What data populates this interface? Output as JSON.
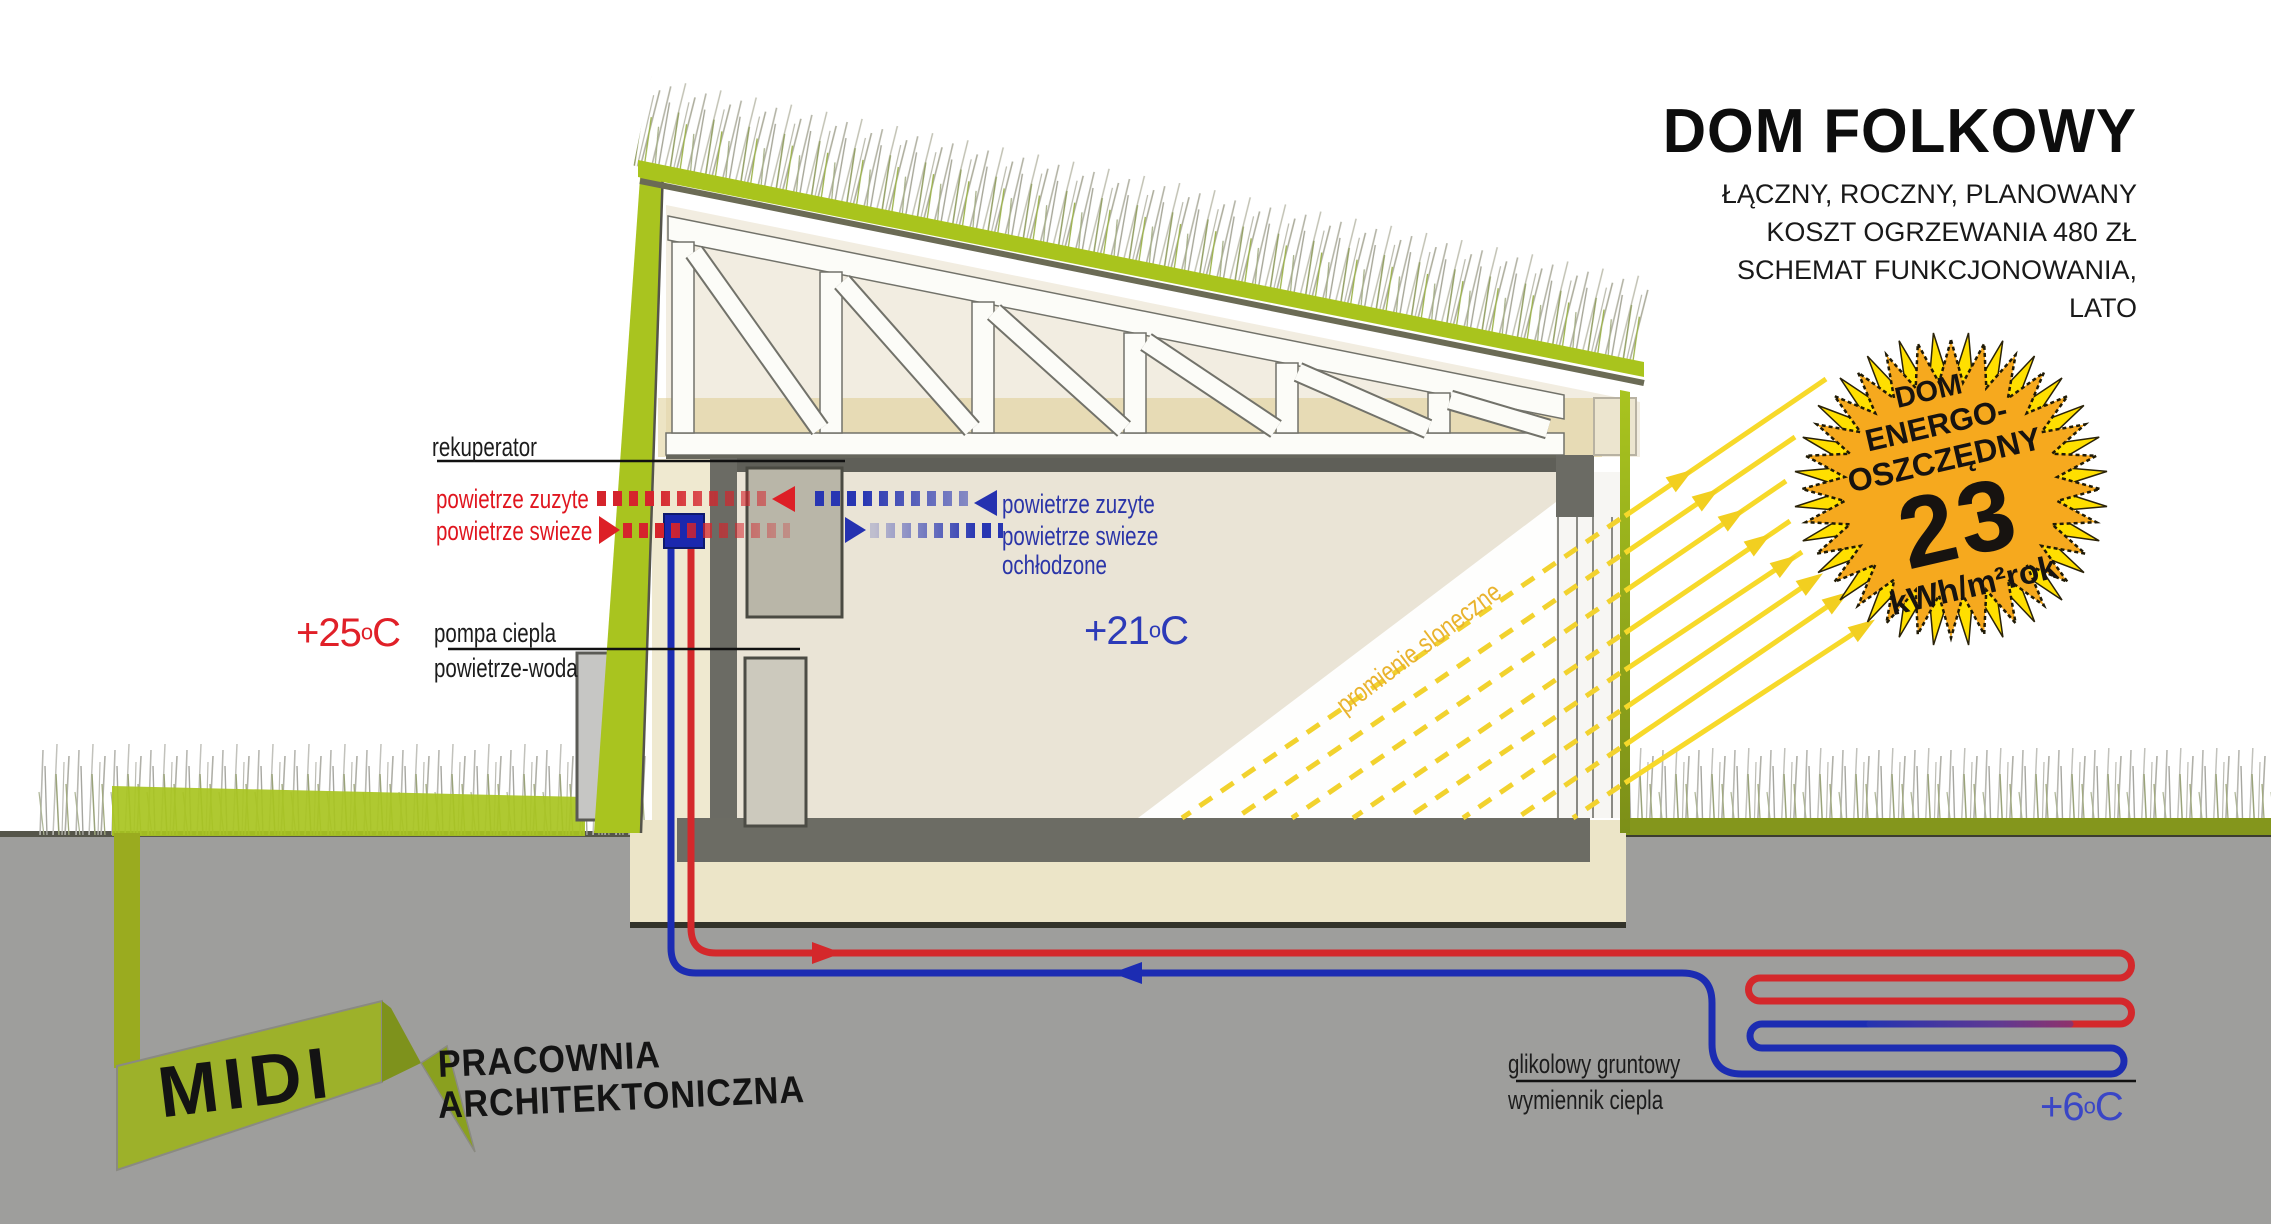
{
  "title": {
    "main": "DOM FOLKOWY",
    "sub1": "ŁĄCZNY, ROCZNY, PLANOWANY",
    "sub2": "KOSZT OGRZEWANIA 480 ZŁ",
    "sub3": "SCHEMAT FUNKCJONOWANIA,",
    "sub4": "LATO"
  },
  "badge": {
    "line1": "DOM",
    "line2": "ENERGO-",
    "line3": "OSZCZĘDNY",
    "value": "23",
    "unit": "kWh/m²rok"
  },
  "labels": {
    "rekuperator": "rekuperator",
    "exhaust_left": "powietrze zuzyte",
    "fresh_left": "powietrze swieze",
    "exhaust_right": "powietrze zuzyte",
    "fresh_right": "powietrze swieze",
    "fresh_right2": "ochłodzone",
    "heat_pump_line1": "pompa ciepla",
    "heat_pump_line2": "powietrze-woda",
    "sun_rays": "promienie sloneczne",
    "ground_hx_line1": "glikolowy gruntowy",
    "ground_hx_line2": "wymiennik ciepla"
  },
  "temperatures": {
    "outside": {
      "value": "+25",
      "degree": "o",
      "unit": "C"
    },
    "inside": {
      "value": "+21",
      "degree": "o",
      "unit": "C"
    },
    "ground": {
      "value": "+6",
      "degree": "o",
      "unit": "C"
    }
  },
  "logo": {
    "name": "MIDI",
    "line1": "PRACOWNIA",
    "line2": "ARCHITEKTONICZNA"
  },
  "colors": {
    "lime_green": "#a9c41f",
    "olive_green": "#84961c",
    "badge_orange": "#f6a91e",
    "badge_yellow": "#ffdf00",
    "pipe_red": "#d4282b",
    "pipe_blue": "#1c2cb2",
    "ray_yellow": "#f7d92a",
    "ground_gray": "#9e9e9c",
    "wall_gray": "#6b6b64"
  }
}
